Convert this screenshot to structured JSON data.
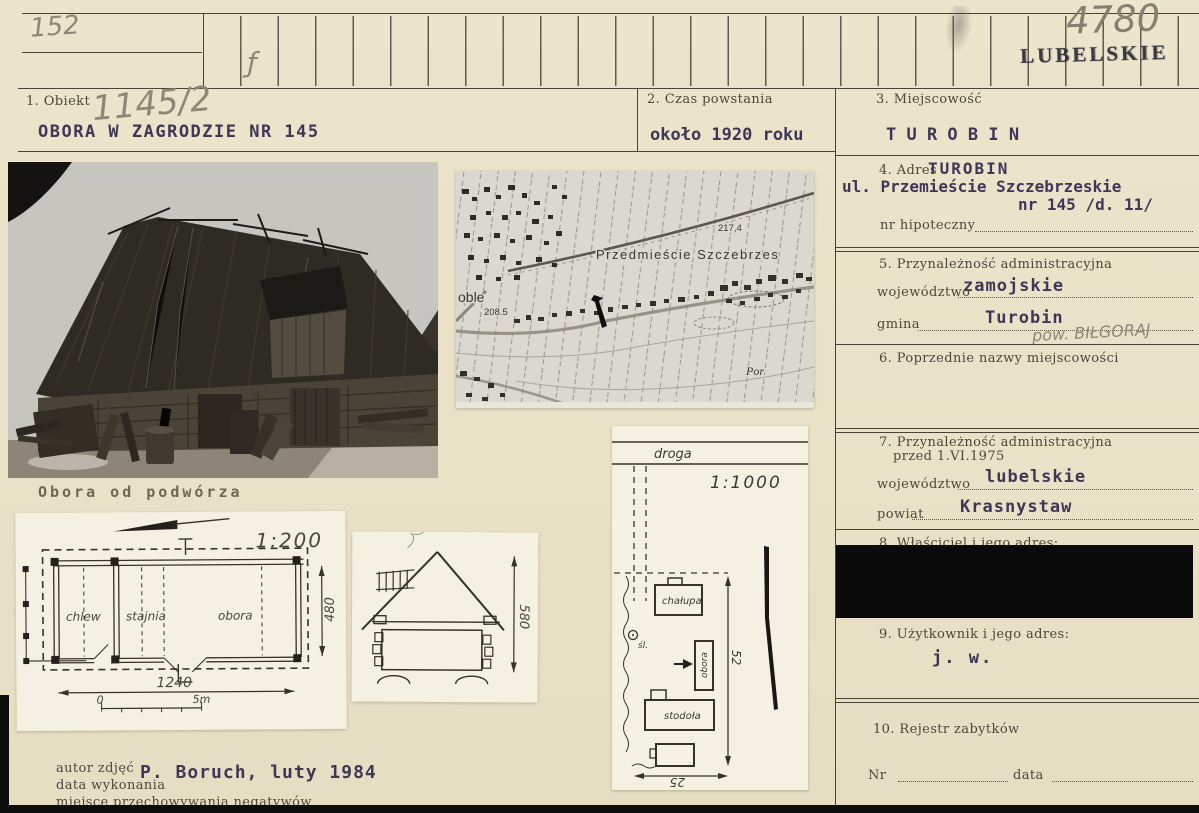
{
  "card": {
    "index_row": {
      "pencil_left": "152",
      "pencil_mark": "ƒ",
      "pencil_right": "4780",
      "stamp": "LUBELSKIE"
    },
    "f1": {
      "label": "1. Obiekt",
      "pencil": "1145/2",
      "value": "OBORA W ZAGRODZIE NR 145"
    },
    "f2": {
      "label": "2. Czas powstania",
      "value": "około 1920 roku"
    },
    "f3": {
      "label": "3. Miejscowość",
      "value": "T U R O B I N"
    },
    "f4": {
      "label": "4. Adres",
      "town": "TUROBIN",
      "street": "ul. Przemieście Szczebrzeskie",
      "number": "nr 145 /d. 11/",
      "hypo_label": "nr hipoteczny"
    },
    "f5": {
      "label": "5. Przynależność administracyjna",
      "voivodeship_label": "województwo",
      "voivodeship": "zamojskie",
      "commune_label": "gmina",
      "commune": "Turobin",
      "pencil_note": "pow. BIŁGORAJ"
    },
    "f6": {
      "label": "6. Poprzednie nazwy miejscowości"
    },
    "f7": {
      "label": "7. Przynależność administracyjna",
      "label2": "przed 1.VI.1975",
      "voivodeship_label": "województwo",
      "voivodeship": "lubelskie",
      "county_label": "powiat",
      "county": "Krasnystaw"
    },
    "f8": {
      "label": "8. Właściciel i jego adres:"
    },
    "f9": {
      "label": "9. Użytkownik i jego adres:",
      "value": "j. w."
    },
    "f10": {
      "label": "10. Rejestr zabytków",
      "nr_label": "Nr",
      "date_label": "data"
    },
    "photo": {
      "caption": "Obora od podwórza"
    },
    "map": {
      "settlement": "Przedmieście Szczebrzes",
      "elevation_1": "217,4",
      "elevation_2": "208.5",
      "partial_name": "oble",
      "river": "Por"
    },
    "floor_plan": {
      "scale": "1:200",
      "room_1": "chlew",
      "room_2": "stajnia",
      "room_3": "obora",
      "width": "1240",
      "height": "480",
      "bar_start": "0",
      "bar_end": "5m"
    },
    "section": {
      "height": "580"
    },
    "site_plan": {
      "road": "droga",
      "scale": "1:1000",
      "house": "chałupa",
      "barn": "obora",
      "shed": "stodoła",
      "well": "śl.",
      "dim_v": "52",
      "dim_h": "25"
    },
    "footer": {
      "line1": "autor zdjęć",
      "line2": "data wykonania",
      "line3": "miejsce przechowywania negatywów",
      "value": "P. Boruch, luty 1984"
    },
    "colors": {
      "card": "#eae2c8",
      "ink": "#3e3757",
      "pencil": "#8e8777",
      "line": "#4a4437"
    }
  }
}
